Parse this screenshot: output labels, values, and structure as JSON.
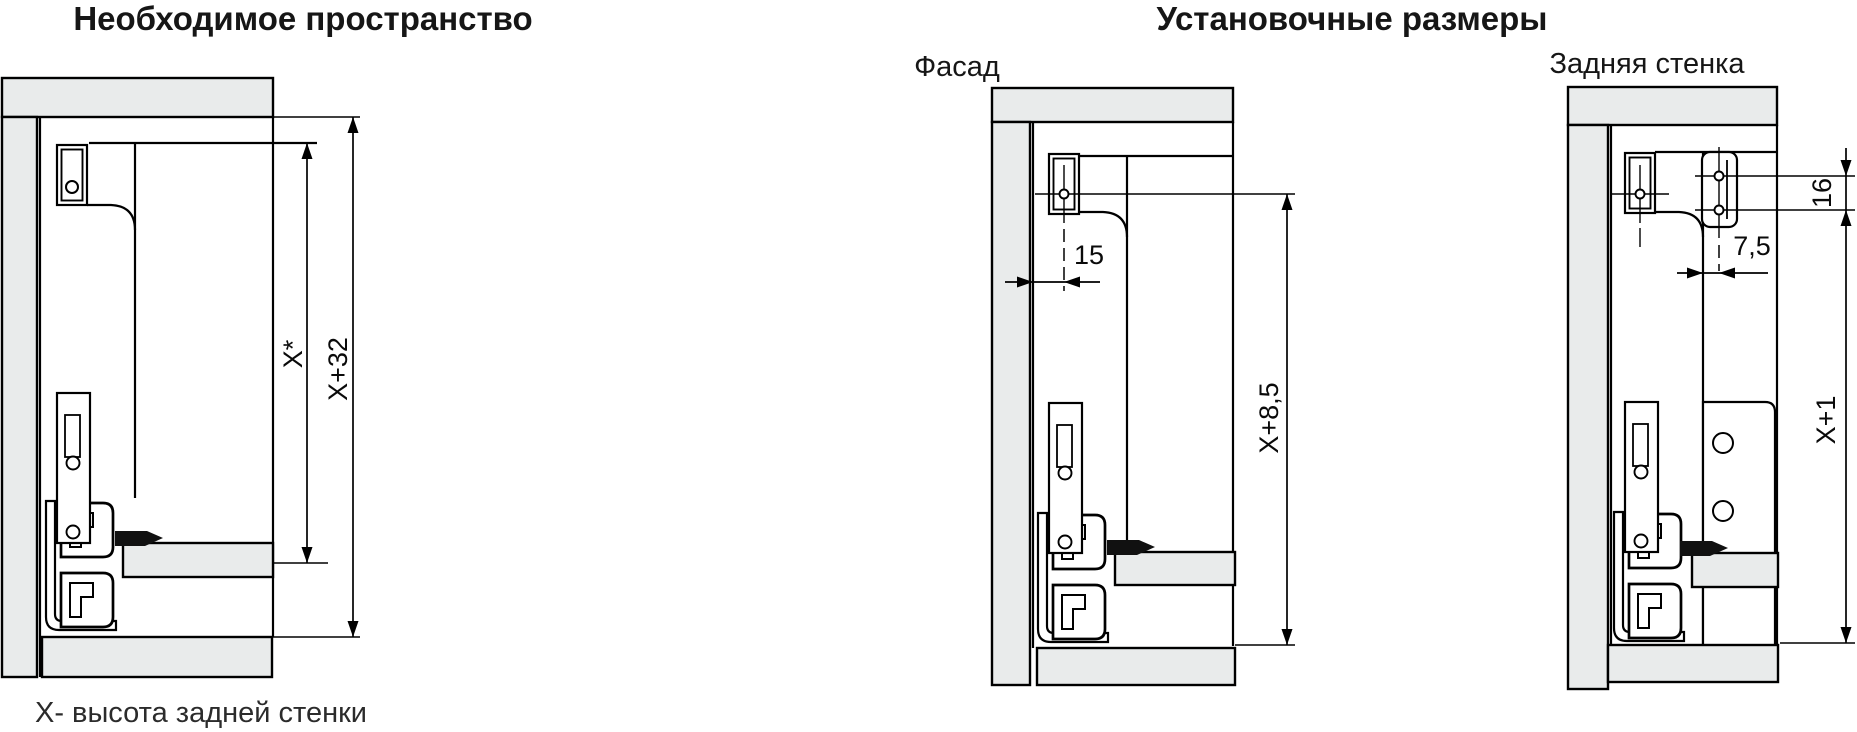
{
  "header": {
    "left_title": "Необходимое пространство",
    "right_title": "Установочные размеры"
  },
  "diagrams": {
    "required_space": {
      "dim_inner": "X*",
      "dim_outer": "X+32"
    },
    "facade": {
      "subtitle": "Фасад",
      "dim_bracket_offset": "15",
      "dim_height": "X+8,5"
    },
    "back_wall": {
      "subtitle": "Задняя стенка",
      "dim_hole_spacing": "16",
      "dim_hole_offset": "7,5",
      "dim_height": "X+1"
    }
  },
  "footnote": "X- высота задней стенки",
  "colors": {
    "panel_fill": "#e9ebeb",
    "line": "#000000",
    "text": "#161616"
  }
}
